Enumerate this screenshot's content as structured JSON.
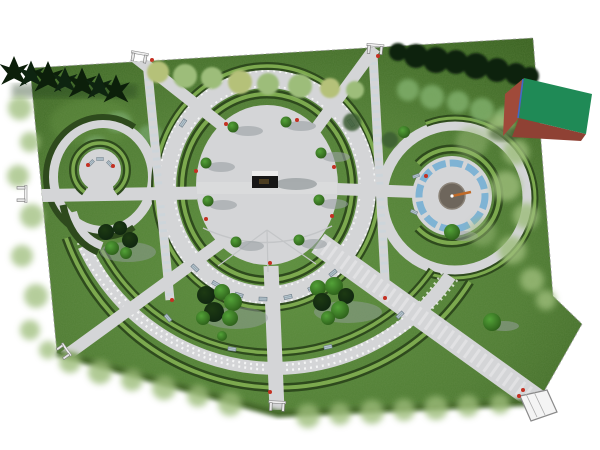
{
  "scene": {
    "type": "aerial-3d-render",
    "description": "Top-down 3D landscape render of a formal park: central circular plaza with monument, radiating walkways, two concentric southern arc walkways, western semicircular bench alcove, eastern sundial-fountain circle with water ring, perimeter tree belts, six gated entrances and a green-roofed cube building at the north-east boundary.",
    "background": "#ffffff",
    "colors": {
      "bg": "#ffffff",
      "grass": "#4f7c33",
      "grass-light": "#5c8f3d",
      "grass-dark": "#38601f",
      "path": "#d4d5d7",
      "path-shade": "#b9bcbe",
      "hedge-dark": "#2e4a1d",
      "hedge-light": "#7ca94e",
      "water": "#7fb3d4",
      "tree-dark": "#0e2410",
      "conifer": "#0c1f0a",
      "tree-mid": "#4c8f2f",
      "tree-bright": "#53a238",
      "tree-light": "#9dbd7a",
      "tree-yellow": "#b5c179",
      "shrub": "#7fae6b",
      "bench": "#b6c5ce",
      "bench-edge": "#6b7a85",
      "bin": "#c43022",
      "cube-top": "#1f8a56",
      "cube-side": "#a04a3a",
      "cube-edge": "#3f6bc9",
      "sundial-center": "#6e665c",
      "gnomon": "#c06a28",
      "shadow": "#9aa0a3",
      "fence": "#9a9a9a",
      "monument": "#161616",
      "monument-top": "#ececec"
    },
    "features": {
      "central_plaza": "circular paved plaza with dark monument and topiary trees",
      "sundial_circle": "east circular plaza with blue water ring and sundial gnomon",
      "bench_alcove": "west semicircular hedge alcove with benches",
      "south_arcs": "two concentric hedge-lined arc walkways",
      "spokes": [
        "west",
        "north-west",
        "north",
        "east",
        "south-east boulevard",
        "south",
        "south-west"
      ],
      "entrances": [
        "top-left gate",
        "top gate",
        "west gate",
        "south gate",
        "south-east pergola gate",
        "south-west gate"
      ],
      "building": "green-roofed cube with brick sides at north-east edge"
    },
    "counts": {
      "plaza_topiaries": 8,
      "ring_benches": 9,
      "alcove_benches": 3,
      "conifers": 7
    }
  }
}
